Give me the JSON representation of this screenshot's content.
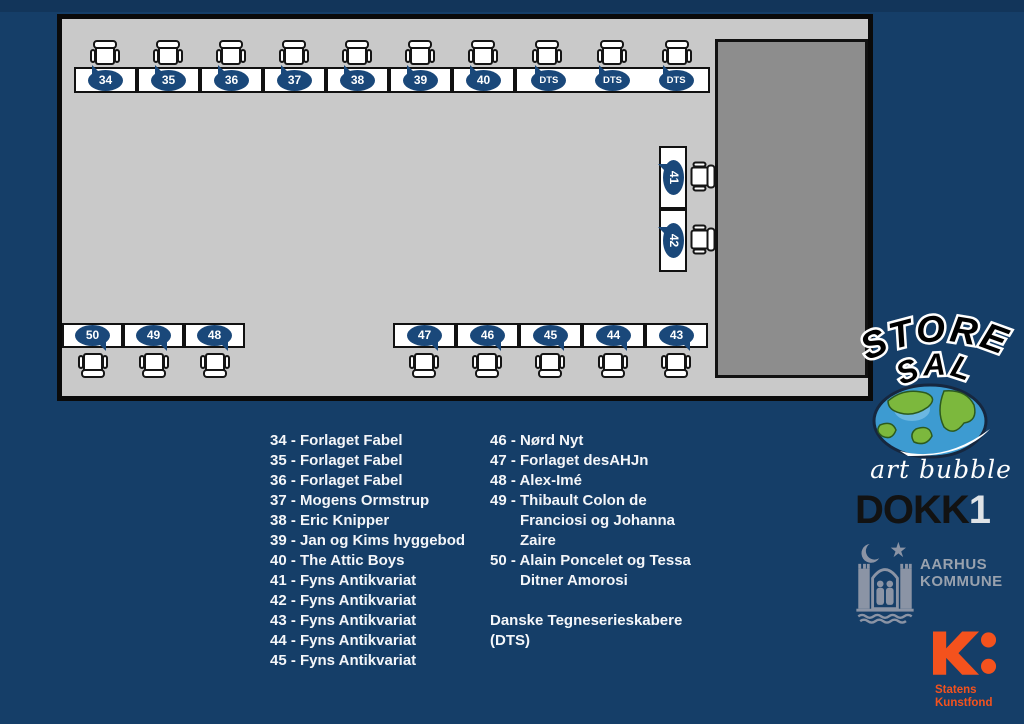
{
  "page": {
    "background": "#153e68",
    "top_strip_color": "#12355a"
  },
  "room": {
    "floor_color": "#c9c9c9",
    "stage_color": "#8d8d8d",
    "wall_color": "#0a0a0a",
    "table_fill": "#ffffff",
    "badge_color": "#1a487a",
    "badge_text_color": "#ffffff"
  },
  "tables": {
    "top": [
      "34",
      "35",
      "36",
      "37",
      "38",
      "39",
      "40"
    ],
    "dts": [
      "DTS",
      "DTS",
      "DTS"
    ],
    "side": [
      "41",
      "42"
    ],
    "bottom_left": [
      "50",
      "49",
      "48"
    ],
    "bottom_right": [
      "47",
      "46",
      "45",
      "44",
      "43"
    ]
  },
  "legend": {
    "left": [
      "34 - Forlaget Fabel",
      "35 - Forlaget Fabel",
      "36 - Forlaget Fabel",
      "37 - Mogens Ormstrup",
      "38 - Eric Knipper",
      "39 - Jan og Kims hyggebod",
      "40 - The Attic Boys",
      "41 - Fyns Antikvariat",
      "42 - Fyns Antikvariat",
      "43 - Fyns Antikvariat",
      "44 - Fyns Antikvariat",
      "45 - Fyns Antikvariat"
    ],
    "right": [
      "46 - Nørd Nyt",
      "47 - Forlaget desAHJn",
      "48 - Alex-Imé",
      "49 - Thibault Colon de Franciosi og Johanna Zaire",
      "50 - Alain Poncelet og Tessa Ditner Amorosi"
    ],
    "dts_note": [
      "Danske Tegneserieskabere",
      "(DTS)"
    ]
  },
  "logos": {
    "store_sal": {
      "line1": "STORE",
      "line2": "SAL"
    },
    "art_bubble": {
      "label": "art bubble"
    },
    "dokk1": {
      "dokk": "DOKK",
      "one": "1"
    },
    "aarhus": {
      "line1": "AARHUS",
      "line2": "KOMMUNE",
      "color": "#99a2ae"
    },
    "kunstfond": {
      "line1": "Statens",
      "line2": "Kunstfond",
      "color": "#f4521d"
    }
  },
  "icons": {
    "chair-icon": "css-shape chair (seat, back, armrests)",
    "speech-bubble-badge": "ellipse with corner tail",
    "globe-icon": "blue/green globe",
    "aarhus-seal-icon": "gray coat of arms with moon, star, towers, waves",
    "kunstfond-k-icon": "orange K with colon dots"
  }
}
